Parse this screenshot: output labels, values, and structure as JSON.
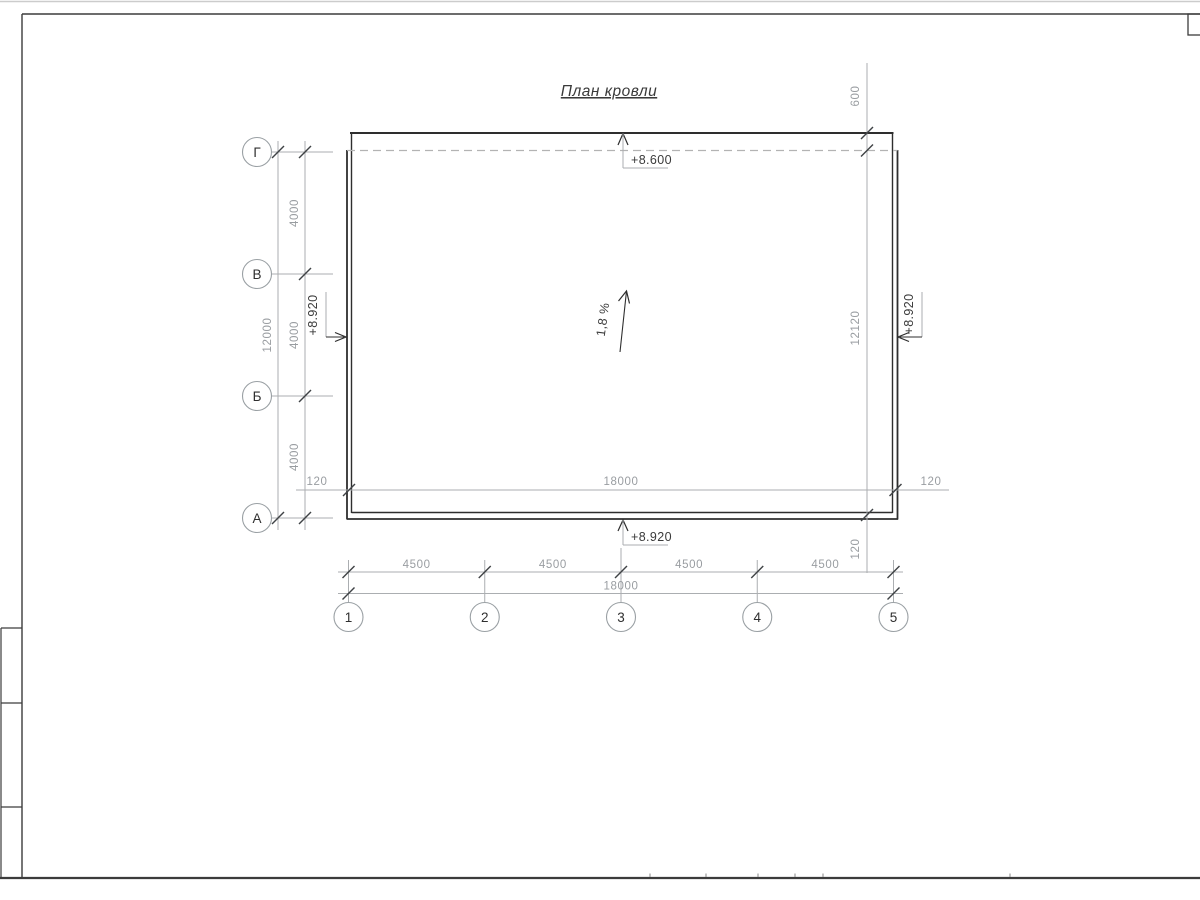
{
  "drawing": {
    "title": "План кровли",
    "slope_label": "1,8 %",
    "elevations": {
      "top": "+8.600",
      "bottom": "+8.920",
      "left": "+8.920",
      "right": "+8.920"
    },
    "grid": {
      "row_labels": [
        "Г",
        "В",
        "Б",
        "А"
      ],
      "col_labels": [
        "1",
        "2",
        "3",
        "4",
        "5"
      ]
    },
    "dims": {
      "row_segments": [
        "4000",
        "4000",
        "4000"
      ],
      "row_total": "12000",
      "col_segments": [
        "4500",
        "4500",
        "4500",
        "4500"
      ],
      "col_total": "18000",
      "width_inner": "18000",
      "parapet_left": "120",
      "parapet_right": "120",
      "parapet_bottom": "120",
      "top_offset": "600",
      "right_height": "12120"
    },
    "colors": {
      "outline": "#2e2e2e",
      "dimension_line": "#abaeb1",
      "dimension_text": "#999da1",
      "dark_text": "#3a3a3a"
    }
  }
}
